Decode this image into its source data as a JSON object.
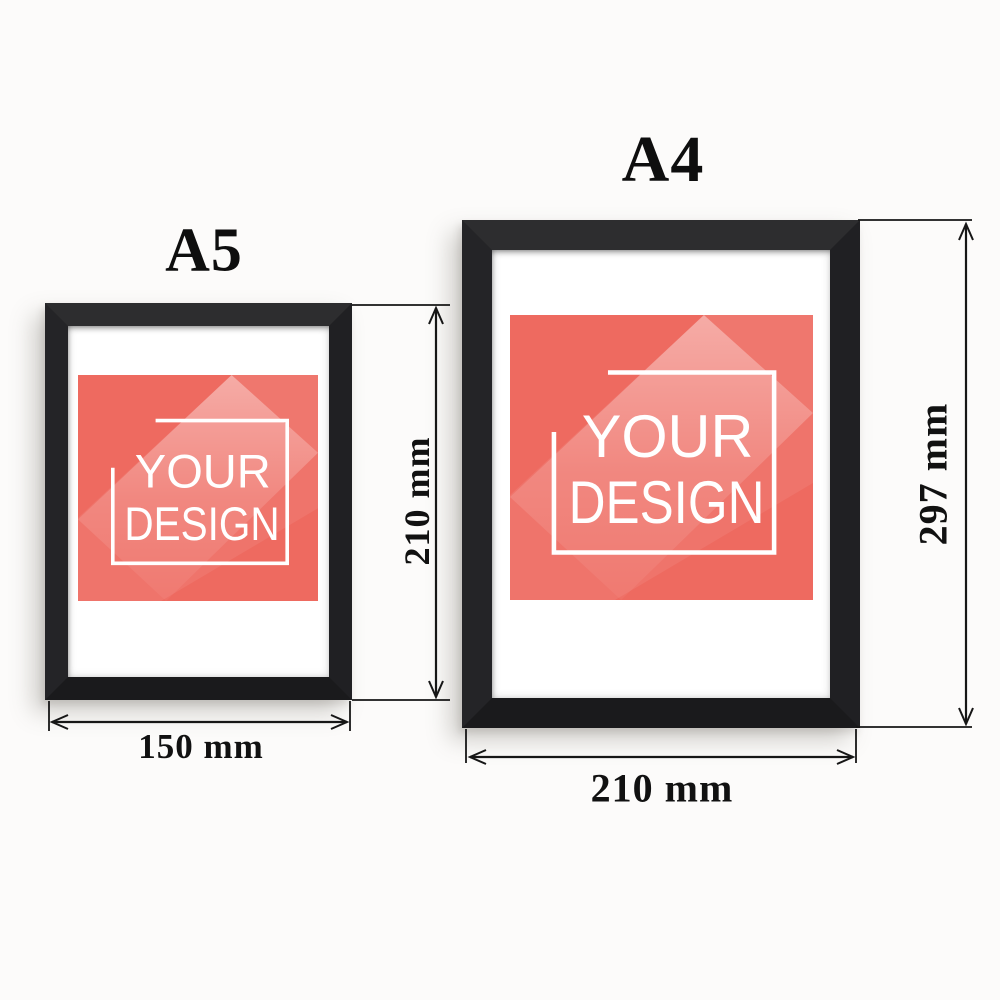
{
  "frames": [
    {
      "label": "A5",
      "width_label": "150 mm",
      "height_label": "210 mm"
    },
    {
      "label": "A4",
      "width_label": "210 mm",
      "height_label": "297 mm"
    }
  ],
  "poster": {
    "line1": "YOUR",
    "line2": "DESIGN",
    "base_color": "#ee6a60",
    "text_color": "#ffffff"
  },
  "colors": {
    "frame": "#202023",
    "paper": "#ffffff",
    "dimension_lines": "#161616",
    "label_text": "#0e0e0e",
    "background": "#fcfbfa"
  }
}
